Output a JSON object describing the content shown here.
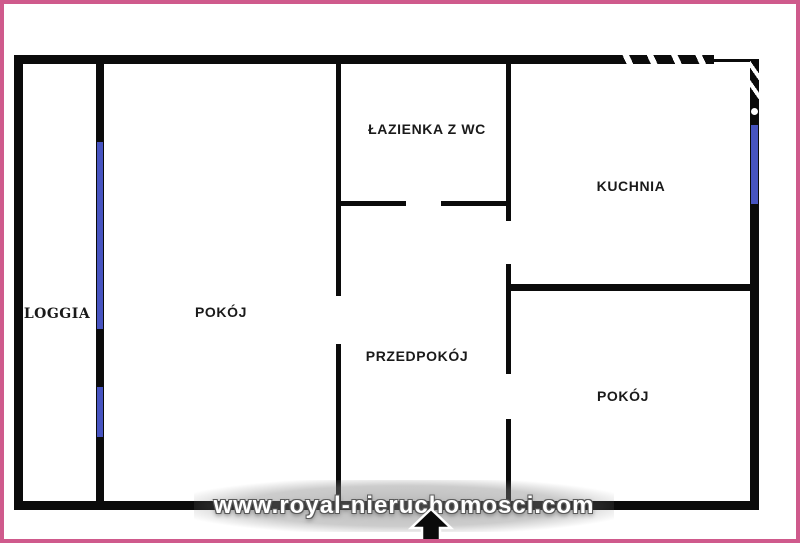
{
  "plan": {
    "title": "apartment-floor-plan",
    "rooms": [
      {
        "id": "lazienka",
        "label": "ŁAZIENKA Z WC"
      },
      {
        "id": "kuchnia",
        "label": "KUCHNIA"
      },
      {
        "id": "loggia",
        "label": "LOGGIA"
      },
      {
        "id": "pokoj_left",
        "label": "POKÓJ"
      },
      {
        "id": "przedpokoj",
        "label": "PRZEDPOKÓJ"
      },
      {
        "id": "pokoj_right",
        "label": "POKÓJ"
      }
    ]
  },
  "watermark": {
    "text": "www.royal-nieruchomosci.com"
  },
  "colors": {
    "border-pink": "#cf5a8c",
    "wall-black": "#0b0b0b",
    "window-blue": "#4754c1",
    "label-text": "#1a1a1a",
    "watermark-text": "#ffffff"
  }
}
